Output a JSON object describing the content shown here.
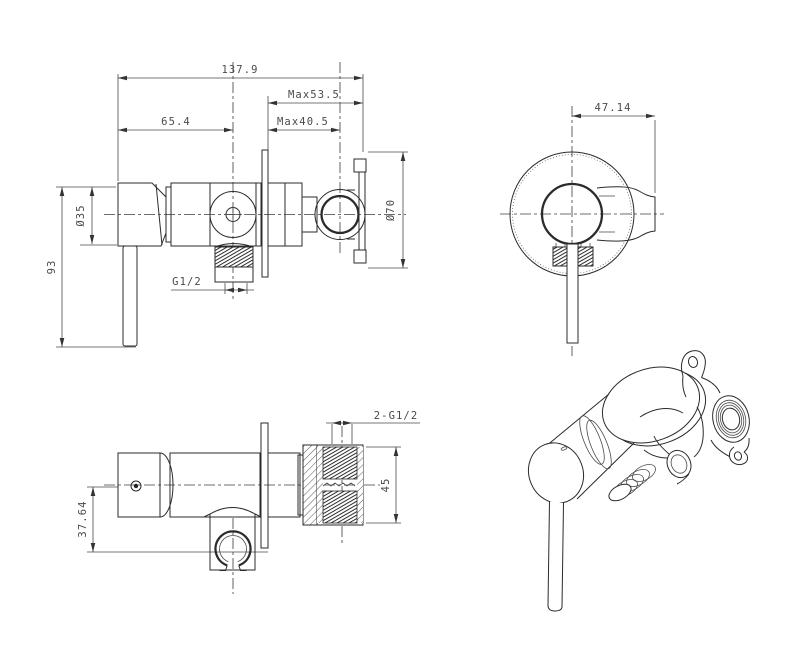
{
  "drawing": {
    "colors": {
      "background": "#ffffff",
      "line": "#2b2b2b",
      "dim": "#4a4a4a"
    },
    "views": {
      "side": {
        "dims": {
          "overall_width": "137.9",
          "holder_max_depth": "Max53.5",
          "knob_to_valve_center": "65.4",
          "plate_max_depth": "Max40.5",
          "body_diameter": "Ø35",
          "flange_diameter": "Ø70",
          "outlet_thread": "G1/2",
          "overall_height": "93"
        }
      },
      "front": {
        "dims": {
          "center_to_bracket_edge": "47.14"
        }
      },
      "top": {
        "dims": {
          "inlet_thread": "2-G1/2",
          "inlet_block_height": "45",
          "center_to_holder": "37.64"
        }
      },
      "perspective": {
        "dims": {}
      }
    }
  }
}
